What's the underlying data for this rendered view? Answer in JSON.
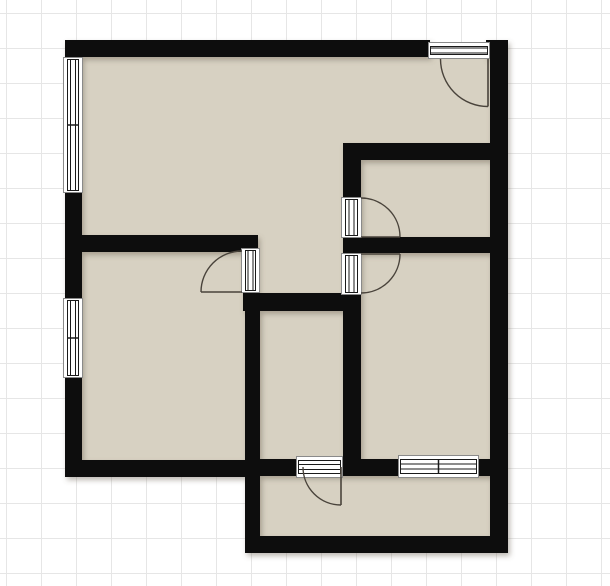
{
  "canvas": {
    "width": 610,
    "height": 586
  },
  "grid": {
    "spacing": 35,
    "offset_x": 6,
    "offset_y": 13,
    "line_color": "#e6e6e6",
    "background": "#ffffff"
  },
  "palette": {
    "floor": "#d7d1c2",
    "wall": "#0e0d0b",
    "band_frame": "#8a8a8a",
    "band_line": "#1a1a1a",
    "band_fill": "#ffffff",
    "swing": "#49433b",
    "shadow": "#6b6254"
  },
  "plan": {
    "floor_outline": "70,45 500,45 500,548 250,548 250,470 70,470",
    "walls": [
      {
        "name": "top-wall",
        "x": 70,
        "y": 40,
        "w": 360,
        "h": 17
      },
      {
        "name": "top-right-corner",
        "x": 486,
        "y": 40,
        "w": 22,
        "h": 18
      },
      {
        "name": "left-wall",
        "x": 65,
        "y": 40,
        "w": 17,
        "h": 437
      },
      {
        "name": "right-wall",
        "x": 490,
        "y": 43,
        "w": 18,
        "h": 510
      },
      {
        "name": "upper-right-room-top",
        "x": 343,
        "y": 143,
        "w": 150,
        "h": 17
      },
      {
        "name": "right-divider",
        "x": 343,
        "y": 237,
        "w": 150,
        "h": 16
      },
      {
        "name": "mid-vertical-wall",
        "x": 343,
        "y": 143,
        "w": 18,
        "h": 332
      },
      {
        "name": "left-divider",
        "x": 82,
        "y": 235,
        "w": 176,
        "h": 17
      },
      {
        "name": "jog-vertical",
        "x": 243,
        "y": 235,
        "w": 15,
        "h": 60
      },
      {
        "name": "jog-horizontal",
        "x": 243,
        "y": 293,
        "w": 118,
        "h": 18
      },
      {
        "name": "corridor-left-wall",
        "x": 245,
        "y": 293,
        "w": 15,
        "h": 260
      },
      {
        "name": "bottom-left-wall",
        "x": 65,
        "y": 460,
        "w": 195,
        "h": 17
      },
      {
        "name": "bottom-mid-wall",
        "x": 258,
        "y": 459,
        "w": 234,
        "h": 17
      },
      {
        "name": "bottom-room-bottom",
        "x": 245,
        "y": 536,
        "w": 263,
        "h": 17
      }
    ],
    "windows": [
      {
        "name": "window-left-upper",
        "x": 63,
        "y": 57,
        "w": 20,
        "h": 136,
        "orientation": "v"
      },
      {
        "name": "window-left-lower",
        "x": 63,
        "y": 298,
        "w": 20,
        "h": 80,
        "orientation": "v"
      },
      {
        "name": "window-bottom",
        "x": 398,
        "y": 455,
        "w": 81,
        "h": 23,
        "orientation": "h"
      }
    ],
    "doors": [
      {
        "name": "door-top-right",
        "glyph": {
          "x": 428,
          "y": 42,
          "w": 62,
          "h": 17,
          "orientation": "h"
        },
        "arc": "M 440.5 59 A 47.5 47.5 0 0 0 488 106.5",
        "leaf": "M 488 59 L 488 106.5"
      },
      {
        "name": "door-mid-upper",
        "glyph": {
          "x": 341,
          "y": 197,
          "w": 21,
          "h": 41,
          "orientation": "v"
        },
        "arc": "M 361 198 A 39 39 0 0 1 400 237",
        "leaf": "M 361 237 L 400 237"
      },
      {
        "name": "door-mid-lower",
        "glyph": {
          "x": 341,
          "y": 253,
          "w": 21,
          "h": 42,
          "orientation": "v"
        },
        "arc": "M 361 293 A 39 39 0 0 0 400 254",
        "leaf": "M 361 254 L 400 254"
      },
      {
        "name": "door-jog",
        "glyph": {
          "x": 241,
          "y": 248,
          "w": 19,
          "h": 45,
          "orientation": "v"
        },
        "arc": "M 242 251 A 41 41 0 0 0 201 292",
        "leaf": "M 201 292 L 242 292"
      },
      {
        "name": "door-bottom",
        "glyph": {
          "x": 296,
          "y": 456,
          "w": 47,
          "h": 22,
          "orientation": "h"
        },
        "arc": "M 303 467 A 38 38 0 0 0 341 505",
        "leaf": "M 341 467 L 341 505"
      }
    ]
  }
}
